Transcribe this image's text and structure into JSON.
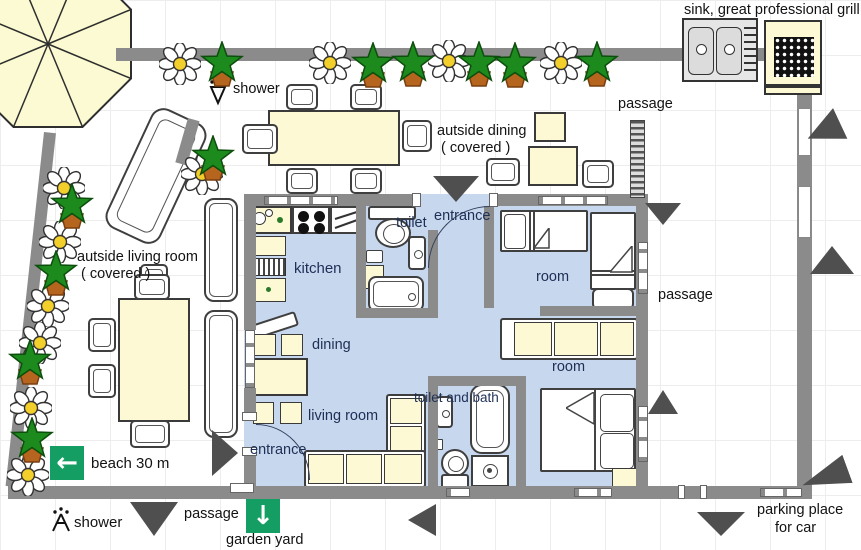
{
  "colors": {
    "wall": "#8b8b8b",
    "floor": "#c7d7ee",
    "furniture": "#fcf9d4",
    "sign": "#149e63",
    "arrow": "#4f4f4f",
    "star": "#1c8a1c",
    "flower_center": "#f2cf2a"
  },
  "labels": {
    "sink_grill": "sink,  great professional grill",
    "shower_top": "shower",
    "passage_top": "passage",
    "outside_dining_l1": "autside dining",
    "outside_dining_l2": "( covered )",
    "entrance_top": "entrance",
    "toilet": "toilet",
    "kitchen": "kitchen",
    "room_top": "room",
    "passage_right": "passage",
    "outside_living_l1": "autside living room",
    "outside_living_l2": "( covered )",
    "dining": "dining",
    "room_bottom": "room",
    "living_room": "living room",
    "toilet_bath": "toilet and bath",
    "entrance_left": "entrance",
    "beach": "beach 30 m",
    "shower_bottom": "shower",
    "passage_bottom": "passage",
    "garden_yard": "garden yard",
    "parking_l1": "parking place",
    "parking_l2": "for car"
  },
  "signs": {
    "beach_arrow": "←",
    "garden_arrow": "↓"
  },
  "decorations": {
    "flowers": [
      [
        180,
        64
      ],
      [
        330,
        63
      ],
      [
        449,
        61
      ],
      [
        561,
        63
      ],
      [
        202,
        174
      ],
      [
        64,
        188
      ],
      [
        60,
        242
      ],
      [
        48,
        306
      ],
      [
        40,
        343
      ],
      [
        31,
        408
      ],
      [
        28,
        475
      ]
    ],
    "star_plants": [
      [
        222,
        64
      ],
      [
        373,
        65
      ],
      [
        413,
        64
      ],
      [
        479,
        64
      ],
      [
        515,
        65
      ],
      [
        597,
        64
      ],
      [
        213,
        158
      ],
      [
        72,
        206
      ],
      [
        56,
        273
      ],
      [
        30,
        362
      ],
      [
        32,
        440
      ]
    ]
  },
  "arrows": [
    {
      "x": 433,
      "y": 176,
      "w": 46,
      "h": 26,
      "dir": "down",
      "rot": 0
    },
    {
      "x": 645,
      "y": 203,
      "w": 36,
      "h": 22,
      "dir": "down",
      "rot": 0
    },
    {
      "x": 806,
      "y": 114,
      "w": 36,
      "h": 34,
      "dir": "left",
      "rot": -25
    },
    {
      "x": 810,
      "y": 246,
      "w": 44,
      "h": 28,
      "dir": "up",
      "rot": 0
    },
    {
      "x": 648,
      "y": 390,
      "w": 30,
      "h": 24,
      "dir": "up",
      "rot": 0
    },
    {
      "x": 212,
      "y": 430,
      "w": 26,
      "h": 46,
      "dir": "right",
      "rot": 0
    },
    {
      "x": 130,
      "y": 502,
      "w": 48,
      "h": 34,
      "dir": "down",
      "rot": 0
    },
    {
      "x": 408,
      "y": 504,
      "w": 28,
      "h": 32,
      "dir": "left",
      "rot": 0
    },
    {
      "x": 697,
      "y": 512,
      "w": 48,
      "h": 24,
      "dir": "down",
      "rot": 0
    },
    {
      "x": 801,
      "y": 462,
      "w": 48,
      "h": 30,
      "dir": "left",
      "rot": -20
    }
  ]
}
